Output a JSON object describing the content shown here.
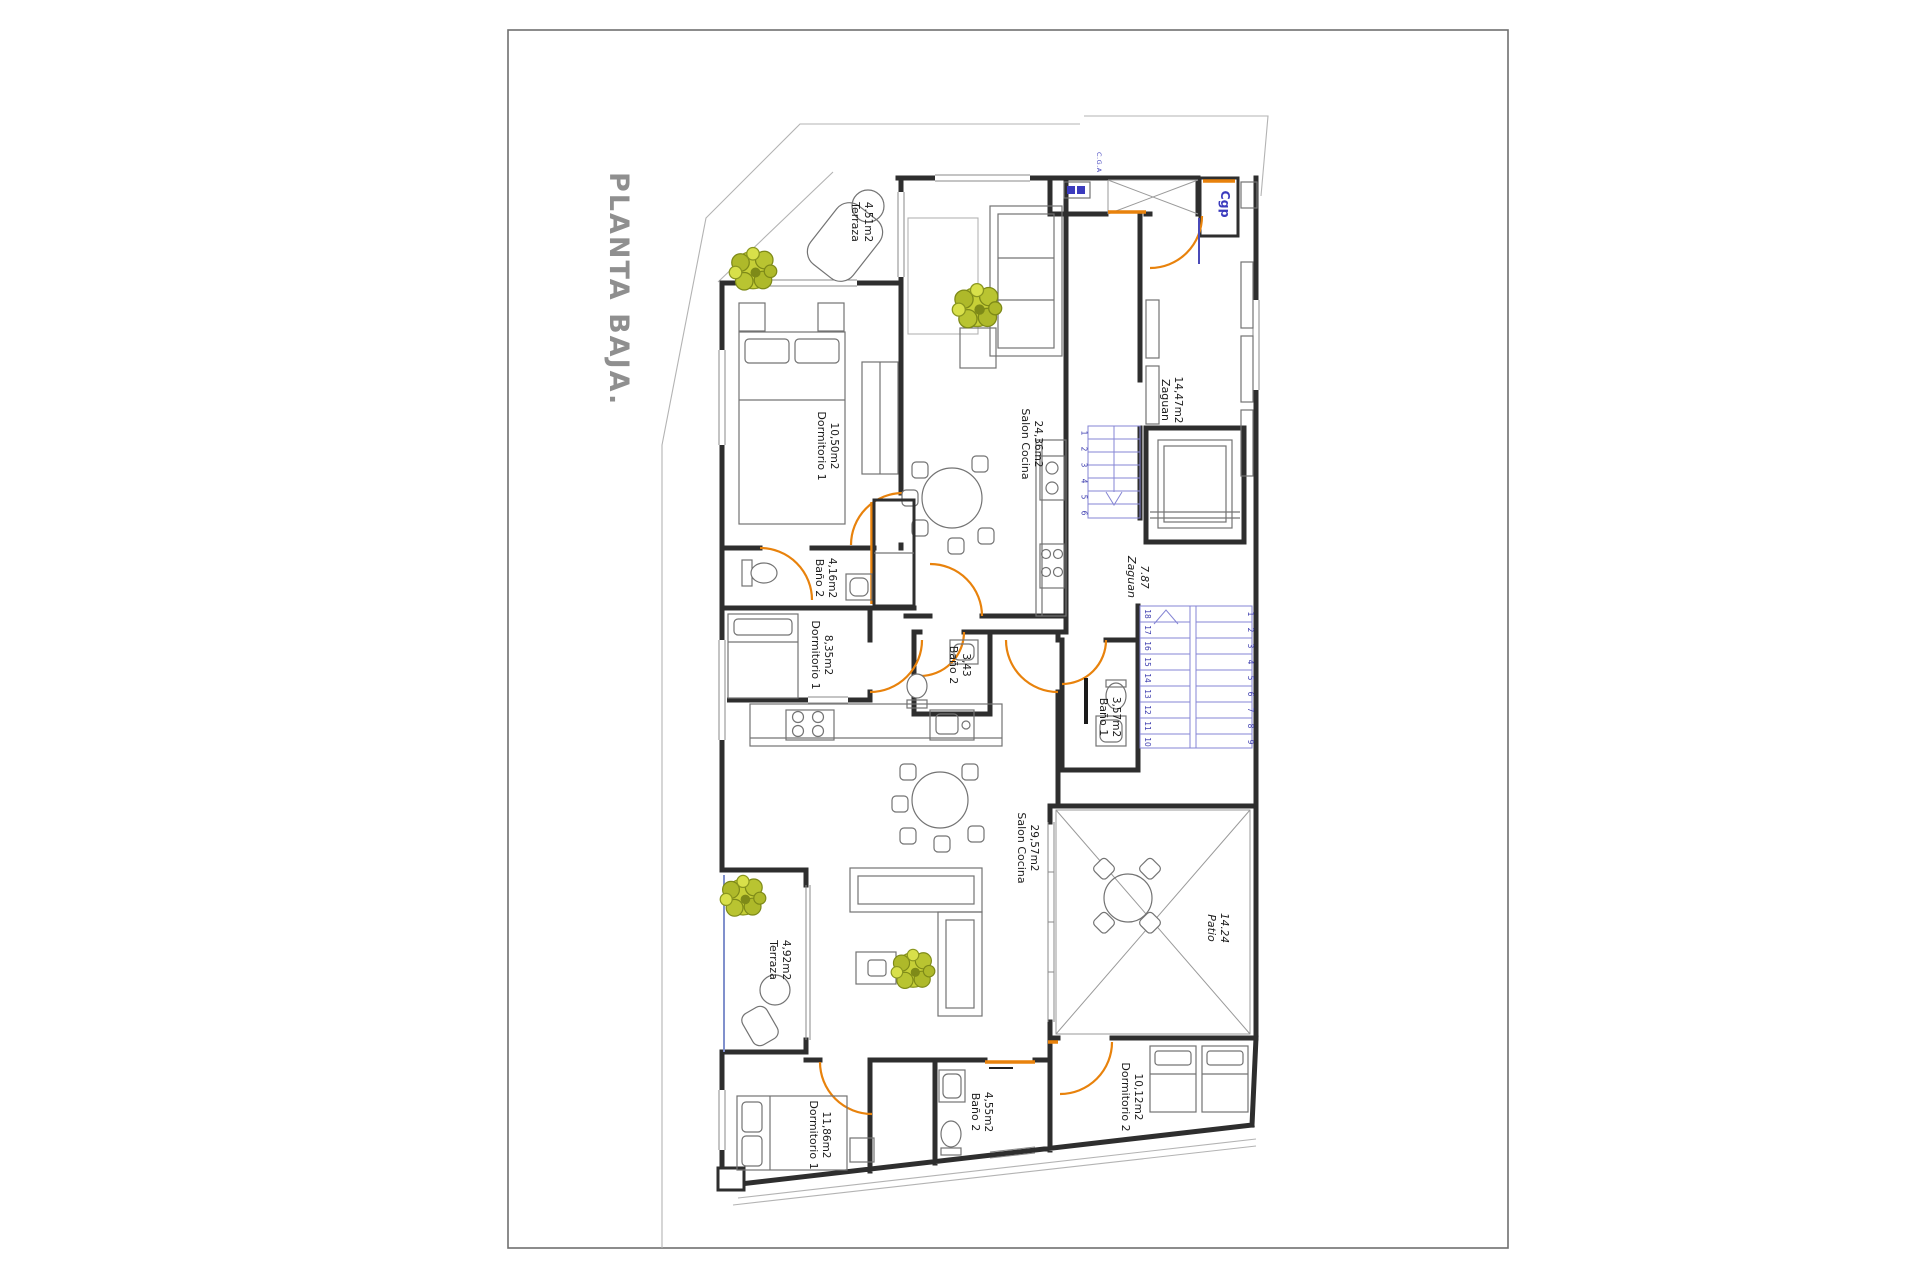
{
  "sheet": {
    "title": "PLANTA BAJA."
  },
  "annotations": {
    "cga": "C.G.A",
    "cgp": "Cgp"
  },
  "rooms": {
    "terraza1": {
      "name": "Terraza",
      "area": "4.51m2"
    },
    "dormitorio1a": {
      "name": "Dormitorio 1",
      "area": "10,50m2"
    },
    "salon1": {
      "name": "Salon Cocina",
      "area": "24,36m2"
    },
    "zaguan1": {
      "name": "Zaguan",
      "area": "14,47m2"
    },
    "bano2a": {
      "name": "Baño 2",
      "area": "4,16m2"
    },
    "dormitorio1b": {
      "name": "Dormitorio 1",
      "area": "8,35m2"
    },
    "bano2b": {
      "name": "Baño 2",
      "area": "3,43"
    },
    "zaguan2": {
      "name": "Zaguan",
      "area": "7.87"
    },
    "bano1": {
      "name": "Baño 1",
      "area": "3,57m2"
    },
    "salon2": {
      "name": "Salon Cocina",
      "area": "29,57m2"
    },
    "patio": {
      "name": "Patio",
      "area": "14.24"
    },
    "terraza2": {
      "name": "Terraza",
      "area": "4,92m2"
    },
    "dormitorio1c": {
      "name": "Dormitorio 1",
      "area": "11,86m2"
    },
    "dormitorio2": {
      "name": "Dormitorio 2",
      "area": "10,12m2"
    },
    "bano2c": {
      "name": "Baño 2",
      "area": "4,55m2"
    }
  },
  "stairs": {
    "upper": {
      "numbers": [
        "1",
        "2",
        "3",
        "4",
        "5",
        "6"
      ]
    },
    "lower_left": {
      "numbers": [
        "18",
        "17",
        "16",
        "15",
        "14",
        "13",
        "12",
        "11",
        "10"
      ]
    },
    "lower_right": {
      "numbers": [
        "1",
        "2",
        "3",
        "4",
        "5",
        "6",
        "7",
        "8",
        "9"
      ]
    }
  },
  "colors": {
    "wall": "#2e2e2e",
    "door": "#e8820c",
    "stairs": "#8585d4",
    "stair_numbers": "#3c3cae",
    "plant": "#b9c431",
    "title": "#8f8f8f",
    "accent_blue": "#3b3bbd",
    "boundary": "#b3b3b3"
  }
}
